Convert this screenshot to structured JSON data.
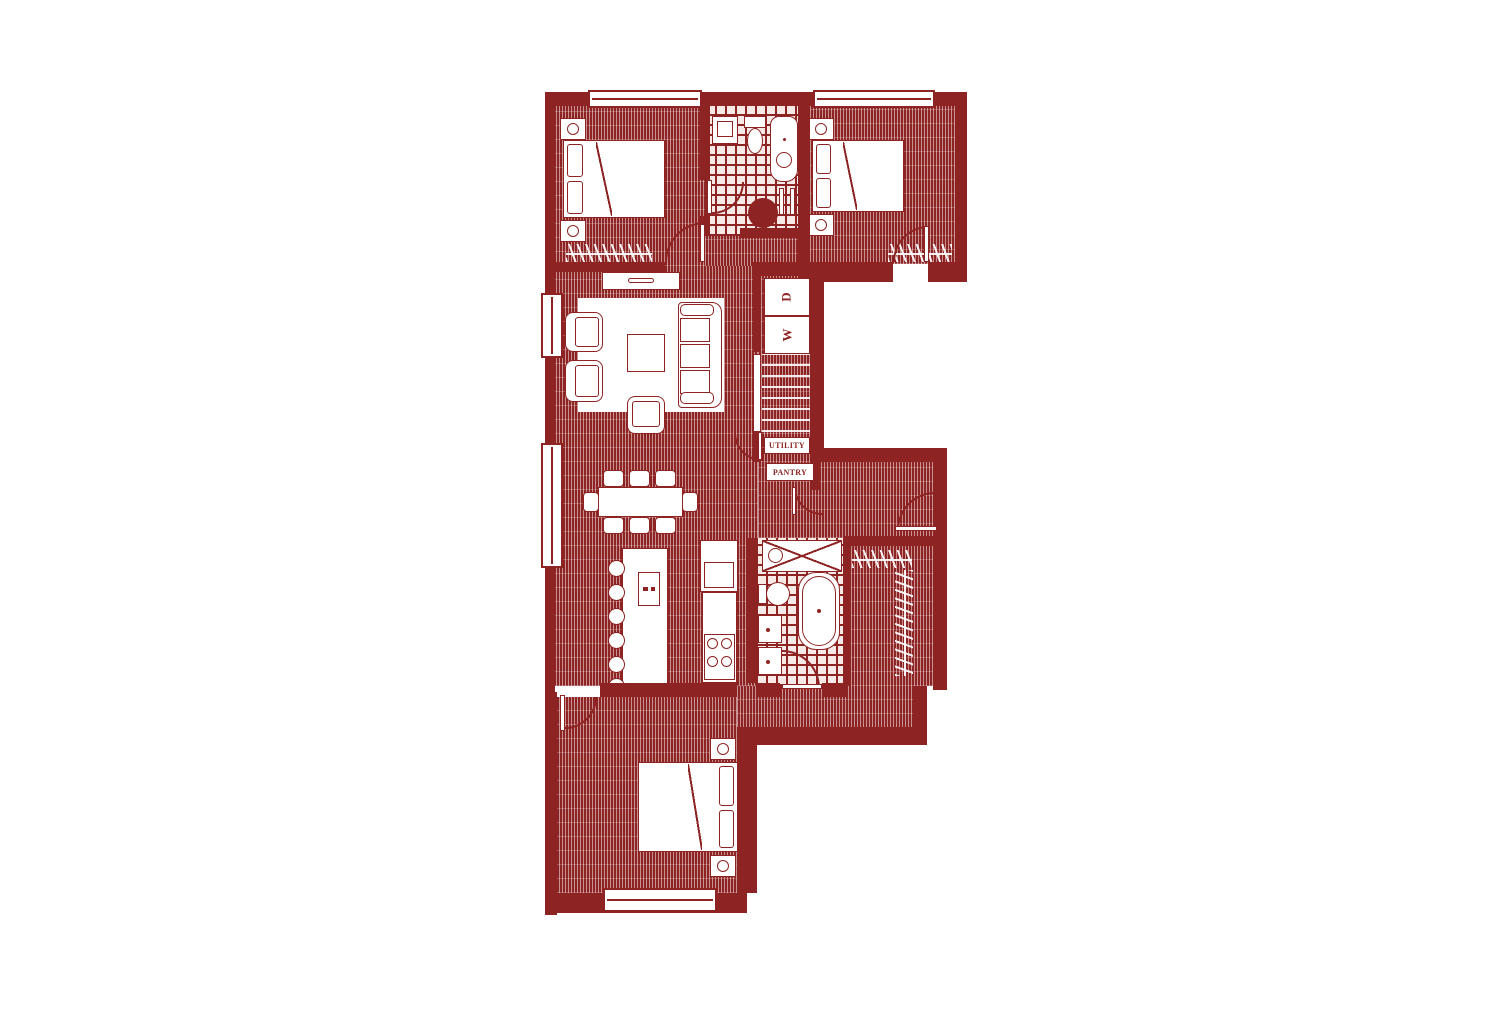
{
  "plan": {
    "type": "apartment-floor-plan",
    "labels": {
      "washer": "W",
      "dryer": "D",
      "utility": "UTILITY",
      "pantry": "PANTRY"
    },
    "colors": {
      "plan_red": "#8e2323",
      "background": "#ffffff",
      "fixture_fill": "#ffffff"
    }
  }
}
